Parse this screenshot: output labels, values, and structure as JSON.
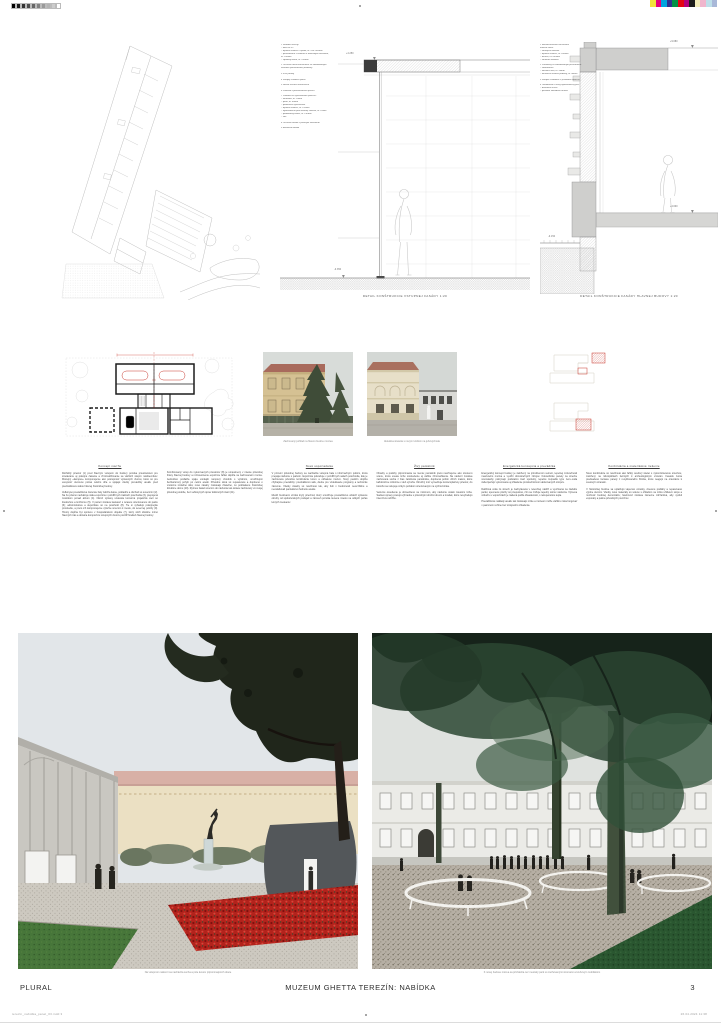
{
  "page": {
    "studio": "PLURAL",
    "title": "MUZEUM GHETTA TEREZÍN: NABÍDKA",
    "page_number": "3"
  },
  "calibration": {
    "grayscale": [
      "#000000",
      "#1a1a1a",
      "#333333",
      "#4d4d4d",
      "#666666",
      "#808080",
      "#999999",
      "#b3b3b3",
      "#cccccc",
      "#ffffff"
    ],
    "colors": [
      "#f2e23a",
      "#e5007d",
      "#00a4de",
      "#2e3192",
      "#009245",
      "#e30613",
      "#b4007c",
      "#1d1d1b",
      "#f2ecba",
      "#f0b6cd",
      "#bedfe9",
      "#a9b8d8"
    ]
  },
  "details": {
    "mid_caption": "Detail konštrukcie vstupnej fasády 1:20",
    "right_caption": "Detail konštrukcie fasády hlavnej budovy 1:20",
    "mid_levels": [
      "+4.250",
      "-0.350"
    ],
    "right_levels": [
      "+9.680",
      "+4.600",
      "-0.150"
    ],
    "mid_annotations": [
      "1 Skladba strechy:",
      "– fólia mPVC",
      "– tepelná izolácia v spáde, hr. 240–400mm",
      "– parozábrana s náterom a adhéznym mostíkom,",
      "   hr. 100mm",
      "– spádový betón, hr. 250mm",
      "",
      "2 Oceľová nosná konštrukcia so zabudovaným",
      "   vetraním prevetrávanej medzery",
      "",
      "3 FVE panely",
      "",
      "4 Stropný chladiaci panel",
      "",
      "5 Nosná oceľová konštrukcia",
      "",
      "6 Podhľad z perforovaného plechu",
      "",
      "7 Podlaha na vykurovanom povrchu:",
      "– keramika, hr. 10mm",
      "– poter, hr. 80mm",
      "– podlahové vykurovanie",
      "– tepelná izolácia, hr. 120mm",
      "– hydroizolácia proti zemnej vlhkosti, hr. 10mm",
      "– podkladový betón, hr. 150mm",
      "– štrk",
      "",
      "8 Oceľová fasáda s pásovým zasklením",
      "",
      "9 Betónová dlažba"
    ],
    "right_annotations": [
      "1 Rekonštruovaná zachovaná",
      "   tehlová stena:",
      "– vonkajšia omietka",
      "– tepelná izolácia, hr. 160mm",
      "– murivo, hr. 600mm",
      "– vnútorná omietka",
      "",
      "2 Predsteny so zabudovaným prevetraním:",
      "– sadrokartón",
      "– kotviaca lišta, hr. 50mm",
      "– akustická izolácia podlahy, hr. 40mm",
      "",
      "3 Stropné chladenie s prívodom vzduchu",
      "",
      "4 Odvodnenie a nový hydroizolačný pás:",
      "– drenážna vrstva",
      "– pôvodné základové murivo"
    ]
  },
  "photos": {
    "caption1": "Zachovaný pohľad na hlavnú budovu múzea",
    "caption2": "Aktuálna situácia s novým krídlom na juhovýchode"
  },
  "essay": {
    "columns": [
      {
        "heading": "Koncept návrhu",
        "paragraphs": [
          "Rozľahlý priestor (1) pred hlavným vstupom do budovy ponúka priestranstvo pre stretávanie aj pokojné čakanie a zhromažďovanie sa väčších skupín návštevníkov. Múzejný «kampus» komponujeme ako postupnosť výstavných dvorov, ktoré sú pre verejnosť otvorené počas celého dňa a spájajú všetky prevádzky areálu pred prednáškovou sálou hlavnej historickej budovy.",
          "Veľkorysé prevádzkové zázemie haly zahŕňa šatne, pokladňu a obchod so suvenírmi (2). Na ňu priamo nadväzuje stála expozícia v pozdĺžnych traktoch poschodia (3), prepojená mostíkom ponad átrium (4). Okruh výstavy uzatvára komorná projekčná sieň so študovňou a knižnicou (5). V parteri zostáva kaviareň s terasou orientovanou do parku (6); administratíva a depozitáre sú na poschodí (8). Tie si vyžadujú pokojnejšie prostredie, a preto ich komponujeme výlučne smerom k mestu, do severnej polohy (9). Hmoty dopĺňa byt správcu v hospodárskom objekte (7), ktorý slúži obsluhe mimo hlavných trás a dotvára kompozíciu vstupných dvorov pozdĺž hradieb hlavnej budovy."
        ]
      },
      {
        "heading": "",
        "paragraphs": [
          "Kombinovaný vstup do vykurovaných priestorov (8) je umiestnený v mieste pôvodnej brány hlavnej budovy a rozmiestnenie expozície ľahko dopĺňa na zachovanom murive. Jednotlivé podlažia spája vonkajší rampový chodník s výťahom, umožňujúci bezbariérový pohyb po celom areáli. Pôvodné okná sú repasované a doplnené o vnútorné izolačné sklá; nové zásahy zostávajú čitateľné, no podriadené historickej štruktúre domu (10). Rytmus fasád smerom do nádvoria tak ostáva zachovaný vo svojej pôvodnej podobe, bez veľkorysých úprav dotknutých častí (11)."
        ]
      },
      {
        "heading": "Nové usporiadanie",
        "paragraphs": [
          "V prízemí pôvodnej budovy sa nachádza vstupná hala s informačným pultom, ktorá prepája nádvorie s parkom. Expozícia pokračuje v pozdĺžnych sálach poschodia, kde je zachovaná pôvodná konštrukcia krovu a odhalené murivo. Nový pavilón dopĺňa chýbajúce prevádzky: prednáškovú sálu, dielne pre vzdelávacie programy a technické zázemie. Všetky zásahy sú navrhnuté tak, aby boli v budúcnosti reverzibilné a neoslabovali pamiatkovú hodnotu areálu.",
          "Medzi budovami vzniká krytý priechod, ktorý umožňuje prevádzkovo oddeliť výstavné okruhy od spoločenských podujatí a zároveň ponúka tienené miesto na oddych počas letných mesiacov."
        ]
      },
      {
        "heading": "Živý pamätník",
        "paragraphs": [
          "Obsahy a podoby pripomínania sa menia; pamätník preto navrhujeme ako otvorenú scénu, ktorá unesie tiché sústredenie aj väčšie zhromaždenia. Na nádvorí zostáva zachovaná socha z čias založenia pamätníka, doplnená poľom vlčích makov, ktoré každoročne rozkvitne v deň výročia. Okružný múr vymedzuje kontemplatívny priestor, do ktorého sa vstupuje úzkym portálom orientovaným na východ slnka.",
          "Večerné osvetlenie je obmedzené na minimum, aby nádvorie ostalo miestom ticha. Sadové úpravy pracujú výhradne s pôvodnými druhmi drevín a trvaliek, ktoré nevyžadujú intenzívnu údržbu."
        ]
      },
      {
        "heading": "Energetická koncepcia a prevádzka",
        "paragraphs": [
          "Energetický koncept budovy je založený na prirodzenom vetraní, tepelnej zotrvačnosti masívneho muriva a využití obnoviteľných zdrojov. Fotovoltické panely na streche novostavby pokrývajú podstatnú časť spotreby, tepelné čerpadlá typu zem–voda zabezpečujú vykurovanie aj chladenie prostredníctvom aktivovaných stropov.",
          "Dažďová voda zo striech je zachytávaná v retenčnej nádrži a využívaná na závlahu parku; spevnené plochy sú priepustné, čím sa znižuje tepelný ostrov nádvoria. Výmena vzduchu v expozíciách je riadená podľa obsadenosti, s rekuperáciou tepla.",
          "Prevádzkové náklady areálu tak zostávajú nízke a múzeum môže väčšinu roka fungovať v pasívnom režime bez strojového chladenia."
        ]
      },
      {
        "heading": "Konštrukcia a materiálové riešenie",
        "paragraphs": [
          "Nové konštrukcie sú navrhnuté ako ľahký oceľový skelet s vykonzolovanou strechou, založený na mikropilótach šetrných k archeologickým vrstvám. Fasádu tvoria predsadené tieniace panely z recyklovaného hliníka, ktoré reagujú na orientáciu k svetovým stranám.",
          "V historickej budove sa uplatňujú vápenné omietky, drevené podlahy a repasované výplne otvorov. Všetky nové materiály sú volené s ohľadom na nízku uhlíkovú stopu a možnosť budúcej demontáže; farebnosť zostáva zámerne zdržanlivá, aby vynikli exponáty a patina pôvodných povrchov."
        ]
      }
    ]
  },
  "renders": {
    "caption1": "Na vstupnom nádvorí sa nachádza socha a pole kvetov pripomínajúcich obete",
    "caption2": "K novej budove múzea sa prichádza cez mestský park so zachovanými stromami a kruhovým mobiliárom"
  },
  "slug": {
    "left": "terezin_nabidka_panel_03.indd 3",
    "right": "26.04.2024 11:38"
  },
  "accent": {
    "plan_red": "#c8392f",
    "flower_red": "#b3231c",
    "canopy_green": "#2c4633"
  }
}
